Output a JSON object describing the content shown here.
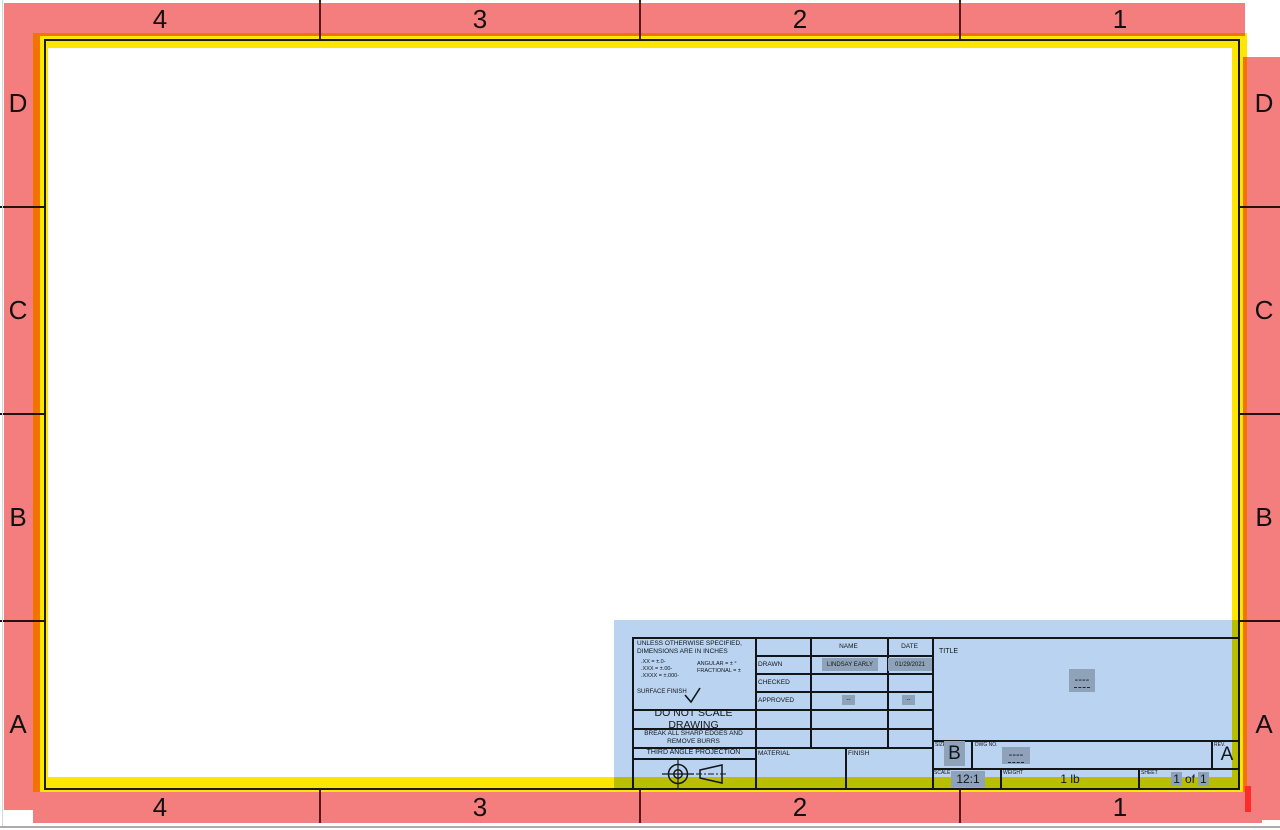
{
  "zones": {
    "top": [
      "4",
      "3",
      "2",
      "1"
    ],
    "bottom": [
      "4",
      "3",
      "2",
      "1"
    ],
    "left": [
      "D",
      "C",
      "B",
      "A"
    ],
    "right": [
      "D",
      "C",
      "B",
      "A"
    ]
  },
  "title_block": {
    "tolerance_note_line1": "UNLESS OTHERWISE SPECIFIED,",
    "tolerance_note_line2": "DIMENSIONS ARE IN INCHES",
    "tol_xx": ".XX = ±.0-",
    "tol_xxx": ".XXX = ±.00-",
    "tol_xxxx": ".XXXX = ±.000-",
    "tol_angular": "ANGULAR = ± °",
    "tol_fractional": "FRACTIONAL = ±",
    "surface_finish_label": "SURFACE FINISH",
    "do_not_scale": "DO NOT SCALE DRAWING",
    "break_edges_line1": "BREAK ALL SHARP EDGES AND",
    "break_edges_line2": "REMOVE BURRS",
    "projection_label": "THIRD ANGLE PROJECTION",
    "material_label": "MATERIAL",
    "finish_label": "FINISH",
    "name_header": "NAME",
    "date_header": "DATE",
    "drawn_label": "DRAWN",
    "checked_label": "CHECKED",
    "approved_label": "APPROVED",
    "drawn_name": "LINDSAY EARLY",
    "drawn_date": "01/29/2021",
    "approved_name_placeholder": "--",
    "approved_date_placeholder": "--",
    "title_label": "TITLE",
    "title_value": "----",
    "size_label": "SIZE",
    "size_value": "B",
    "dwg_no_label": "DWG NO.",
    "dwg_no_value": "----",
    "rev_label": "REV.",
    "rev_value": "A",
    "scale_label": "SCALE",
    "scale_value": "12:1",
    "weight_label": "WEIGHT",
    "weight_value": "1 lb",
    "sheet_label": "SHEET",
    "sheet_value_parts": [
      "1",
      "of",
      "1"
    ]
  },
  "colors": {
    "margin_red": "#F47E7E",
    "border_highlight_yellow": "#FFE600",
    "selection_blue": "#B9D3F1",
    "field_gray": "#C4C4C4",
    "handle_red": "#FF2A2A"
  }
}
